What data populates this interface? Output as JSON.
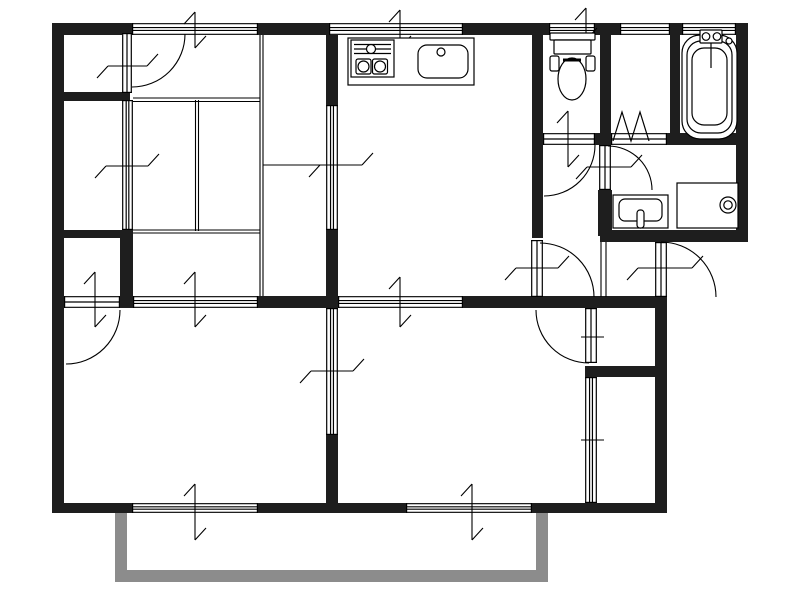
{
  "floorplan": {
    "canvas": {
      "width": 800,
      "height": 600,
      "background": "#ffffff"
    },
    "colors": {
      "wall": "#1e1e1e",
      "line": "#000000",
      "balcony": "#8c8c8c",
      "fill": "#ffffff"
    },
    "walls": [
      {
        "name": "outer-wall-top-1",
        "x": 52,
        "y": 23,
        "w": 80,
        "h": 12
      },
      {
        "name": "outer-wall-top-2",
        "x": 258,
        "y": 23,
        "w": 71,
        "h": 12
      },
      {
        "name": "outer-wall-top-3",
        "x": 463,
        "y": 23,
        "w": 86,
        "h": 12
      },
      {
        "name": "outer-wall-top-4",
        "x": 595,
        "y": 23,
        "w": 25,
        "h": 12
      },
      {
        "name": "outer-wall-top-5",
        "x": 670,
        "y": 23,
        "w": 12,
        "h": 12
      },
      {
        "name": "outer-wall-top-corner",
        "x": 736,
        "y": 23,
        "w": 12,
        "h": 12
      },
      {
        "name": "outer-wall-left",
        "x": 52,
        "y": 23,
        "w": 12,
        "h": 490
      },
      {
        "name": "outer-wall-bottom-1",
        "x": 52,
        "y": 503,
        "w": 80,
        "h": 10
      },
      {
        "name": "outer-wall-bottom-2",
        "x": 258,
        "y": 503,
        "w": 148,
        "h": 10
      },
      {
        "name": "outer-wall-bottom-3",
        "x": 532,
        "y": 503,
        "w": 135,
        "h": 10
      },
      {
        "name": "outer-wall-right-upper",
        "x": 736,
        "y": 23,
        "w": 12,
        "h": 219
      },
      {
        "name": "wall-washroom-south",
        "x": 600,
        "y": 230,
        "w": 148,
        "h": 12
      },
      {
        "name": "outer-wall-right-lower",
        "x": 655,
        "y": 297,
        "w": 12,
        "h": 216
      },
      {
        "name": "wall-kitchen-toilet",
        "x": 532,
        "y": 24,
        "w": 11,
        "h": 214
      },
      {
        "name": "wall-toilet-storage",
        "x": 600,
        "y": 24,
        "w": 11,
        "h": 109
      },
      {
        "name": "wall-storage-bath",
        "x": 670,
        "y": 35,
        "w": 10,
        "h": 110
      },
      {
        "name": "wall-toilet-south-chunk",
        "x": 595,
        "y": 133,
        "w": 16,
        "h": 12
      },
      {
        "name": "wall-bath-south",
        "x": 667,
        "y": 133,
        "w": 81,
        "h": 12
      },
      {
        "name": "wall-washroom-west",
        "x": 598,
        "y": 190,
        "w": 14,
        "h": 46
      },
      {
        "name": "wall-closet-nw-south",
        "x": 52,
        "y": 92,
        "w": 78,
        "h": 9
      },
      {
        "name": "wall-closet-w-south",
        "x": 52,
        "y": 230,
        "w": 81,
        "h": 8
      },
      {
        "name": "wall-closet-w-east",
        "x": 120,
        "y": 230,
        "w": 13,
        "h": 78
      },
      {
        "name": "wall-dk-west-upper",
        "x": 326,
        "y": 35,
        "w": 12,
        "h": 70
      },
      {
        "name": "wall-dk-west-lower",
        "x": 326,
        "y": 230,
        "w": 12,
        "h": 66
      },
      {
        "name": "wall-band-center",
        "x": 258,
        "y": 296,
        "w": 80,
        "h": 12
      },
      {
        "name": "wall-band-east",
        "x": 463,
        "y": 296,
        "w": 204,
        "h": 12
      },
      {
        "name": "wall-rooms-partition-lower",
        "x": 326,
        "y": 435,
        "w": 12,
        "h": 68
      },
      {
        "name": "wall-closet-se-divider",
        "x": 585,
        "y": 366,
        "w": 70,
        "h": 11
      }
    ],
    "balcony_rails": [
      {
        "name": "balcony-rail-left",
        "x": 115,
        "y": 513,
        "w": 12,
        "h": 69
      },
      {
        "name": "balcony-rail-bottom",
        "x": 115,
        "y": 570,
        "w": 433,
        "h": 12
      },
      {
        "name": "balcony-rail-right",
        "x": 536,
        "y": 513,
        "w": 12,
        "h": 69
      }
    ],
    "windows": [
      {
        "name": "window-top-tatami",
        "x": 132,
        "y": 23,
        "w": 126,
        "h": 12,
        "o": "h"
      },
      {
        "name": "window-top-kitchen",
        "x": 329,
        "y": 23,
        "w": 134,
        "h": 12,
        "o": "h"
      },
      {
        "name": "window-top-toilet",
        "x": 549,
        "y": 23,
        "w": 46,
        "h": 12,
        "o": "h"
      },
      {
        "name": "window-top-storage",
        "x": 620,
        "y": 23,
        "w": 50,
        "h": 12,
        "o": "h"
      },
      {
        "name": "window-top-bath",
        "x": 682,
        "y": 23,
        "w": 54,
        "h": 12,
        "o": "h"
      },
      {
        "name": "window-bottom-left",
        "x": 132,
        "y": 503,
        "w": 126,
        "h": 10,
        "o": "h"
      },
      {
        "name": "window-bottom-right",
        "x": 406,
        "y": 503,
        "w": 126,
        "h": 10,
        "o": "h"
      }
    ],
    "sliding_panels": [
      {
        "name": "fusuma-tatami-south",
        "x": 133,
        "y": 296,
        "w": 125,
        "h": 12,
        "o": "h"
      },
      {
        "name": "sliding-partition-dk-south",
        "x": 338,
        "y": 296,
        "w": 125,
        "h": 12,
        "o": "h"
      },
      {
        "name": "fusuma-closet-west",
        "x": 122,
        "y": 100,
        "w": 11,
        "h": 130,
        "o": "v"
      },
      {
        "name": "sliding-door-dk-west",
        "x": 326,
        "y": 105,
        "w": 12,
        "h": 125,
        "o": "v"
      },
      {
        "name": "sliding-partition-rooms",
        "x": 326,
        "y": 308,
        "w": 12,
        "h": 127,
        "o": "v"
      },
      {
        "name": "closet-front-southeast",
        "x": 585,
        "y": 377,
        "w": 12,
        "h": 126,
        "o": "v"
      }
    ],
    "door_leaves": [
      {
        "name": "closet-door-leaf-northwest",
        "x": 122,
        "y": 33,
        "w": 10,
        "h": 60,
        "o": "v"
      },
      {
        "name": "toilet-door-leaf",
        "x": 543,
        "y": 133,
        "w": 52,
        "h": 12,
        "o": "h"
      },
      {
        "name": "washroom-door-leaf",
        "x": 599,
        "y": 145,
        "w": 12,
        "h": 45,
        "o": "v"
      },
      {
        "name": "kitchen-door-leaf",
        "x": 531,
        "y": 240,
        "w": 12,
        "h": 57,
        "o": "v"
      },
      {
        "name": "entrance-door-leaf",
        "x": 655,
        "y": 242,
        "w": 12,
        "h": 55,
        "o": "v"
      },
      {
        "name": "closet-door-leaf-east",
        "x": 585,
        "y": 308,
        "w": 12,
        "h": 55,
        "o": "v"
      },
      {
        "name": "closet-door-leaf-west",
        "x": 64,
        "y": 296,
        "w": 56,
        "h": 12,
        "o": "h"
      }
    ],
    "door_arcs": [
      {
        "name": "closet-door-arc-northwest",
        "d": "M 185 34 A 53 53 0 0 1 132 87"
      },
      {
        "name": "toilet-door-arc",
        "d": "M 595 145 A 51 51 0 0 1 544 196"
      },
      {
        "name": "washroom-door-arc",
        "d": "M 608 146 A 44 44 0 0 1 652 190"
      },
      {
        "name": "kitchen-door-arc",
        "d": "M 540 243 A 54 54 0 0 1 594 297"
      },
      {
        "name": "entrance-door-arc",
        "d": "M 661 242 A 55 55 0 0 1 716 297"
      },
      {
        "name": "closet-door-arc-east",
        "d": "M 536 310 A 53 53 0 0 0 589 363"
      },
      {
        "name": "closet-door-arc-west",
        "d": "M 120 310 A 54 54 0 0 1 66 364"
      }
    ],
    "bifold_door": {
      "name": "bifold-door-storage",
      "band": {
        "x": 611,
        "y": 133,
        "w": 56,
        "h": 12,
        "o": "h"
      },
      "zigzag": "613,141 622,112 631,141 640,112 649,141"
    },
    "ticks": [
      {
        "name": "opening-mark",
        "t": "v",
        "x": 195,
        "a": 12,
        "b": 48,
        "hooks": true
      },
      {
        "name": "opening-mark",
        "t": "v",
        "x": 400,
        "a": 10,
        "b": 48,
        "hooks": true
      },
      {
        "name": "opening-mark",
        "t": "v",
        "x": 586,
        "a": 8,
        "b": 40,
        "hooks": true
      },
      {
        "name": "opening-mark",
        "t": "v",
        "x": 195,
        "a": 484,
        "b": 540,
        "hooks": true
      },
      {
        "name": "opening-mark",
        "t": "v",
        "x": 472,
        "a": 484,
        "b": 540,
        "hooks": true
      },
      {
        "name": "opening-mark",
        "t": "v",
        "x": 95,
        "a": 272,
        "b": 327,
        "hooks": true
      },
      {
        "name": "opening-mark",
        "t": "v",
        "x": 195,
        "a": 272,
        "b": 327,
        "hooks": true
      },
      {
        "name": "opening-mark",
        "t": "v",
        "x": 400,
        "a": 277,
        "b": 327,
        "hooks": true
      },
      {
        "name": "opening-mark",
        "t": "v",
        "x": 568,
        "a": 111,
        "b": 167,
        "hooks": true
      },
      {
        "name": "opening-mark",
        "t": "h",
        "y": 66,
        "a": 108,
        "b": 147,
        "hooks": true
      },
      {
        "name": "opening-mark",
        "t": "h",
        "y": 166,
        "a": 106,
        "b": 148,
        "hooks": true
      },
      {
        "name": "opening-mark",
        "t": "h",
        "y": 165,
        "a": 320,
        "b": 362,
        "hooks": true
      },
      {
        "name": "opening-mark",
        "t": "h",
        "y": 371,
        "a": 311,
        "b": 353,
        "hooks": true
      },
      {
        "name": "opening-mark",
        "t": "h",
        "y": 268,
        "a": 516,
        "b": 558,
        "hooks": true
      },
      {
        "name": "opening-mark",
        "t": "h",
        "y": 167,
        "a": 587,
        "b": 631,
        "hooks": true
      },
      {
        "name": "opening-mark",
        "t": "h",
        "y": 268,
        "a": 638,
        "b": 692,
        "hooks": true
      },
      {
        "name": "opening-mark",
        "t": "h",
        "y": 337,
        "a": 581,
        "b": 604,
        "hooks": false
      },
      {
        "name": "opening-mark",
        "t": "h",
        "y": 440,
        "a": 581,
        "b": 604,
        "hooks": false
      }
    ],
    "thin_lines": [
      {
        "name": "tatami-line",
        "x1": 133,
        "y1": 98,
        "x2": 260,
        "y2": 98
      },
      {
        "name": "tatami-line",
        "x1": 133,
        "y1": 101.5,
        "x2": 260,
        "y2": 101.5
      },
      {
        "name": "tatami-line",
        "x1": 195.5,
        "y1": 100,
        "x2": 195.5,
        "y2": 231
      },
      {
        "name": "tatami-line",
        "x1": 198.5,
        "y1": 100,
        "x2": 198.5,
        "y2": 231
      },
      {
        "name": "tatami-line",
        "x1": 133,
        "y1": 230,
        "x2": 260,
        "y2": 230
      },
      {
        "name": "tatami-line",
        "x1": 133,
        "y1": 233,
        "x2": 260,
        "y2": 233
      },
      {
        "name": "closet-front-line",
        "x1": 260,
        "y1": 35,
        "x2": 260,
        "y2": 296
      },
      {
        "name": "closet-front-line",
        "x1": 263,
        "y1": 35,
        "x2": 263,
        "y2": 296
      },
      {
        "name": "closet-divider-line",
        "x1": 263,
        "y1": 165,
        "x2": 326,
        "y2": 165
      },
      {
        "name": "genkan-step-line",
        "x1": 601,
        "y1": 242,
        "x2": 601,
        "y2": 297
      },
      {
        "name": "genkan-step-line",
        "x1": 606,
        "y1": 242,
        "x2": 606,
        "y2": 297
      }
    ],
    "fixtures": [
      {
        "name": "kitchen-counter",
        "shapes": [
          {
            "k": "rect",
            "x": 348,
            "y": 38,
            "w": 126,
            "h": 47,
            "rx": 0
          }
        ]
      },
      {
        "name": "gas-stove",
        "shapes": [
          {
            "k": "rect",
            "x": 351,
            "y": 40,
            "w": 43,
            "h": 37,
            "rx": 0
          },
          {
            "k": "line",
            "x1": 354,
            "y1": 44.5,
            "x2": 391,
            "y2": 44.5
          },
          {
            "k": "line",
            "x1": 354,
            "y1": 49,
            "x2": 391,
            "y2": 49
          },
          {
            "k": "line",
            "x1": 354,
            "y1": 53.5,
            "x2": 391,
            "y2": 53.5
          },
          {
            "k": "circle",
            "cx": 371,
            "cy": 49,
            "r": 4.5
          },
          {
            "k": "rect",
            "x": 356,
            "y": 59,
            "w": 15,
            "h": 15,
            "rx": 2
          },
          {
            "k": "rect",
            "x": 372.5,
            "y": 59,
            "w": 15,
            "h": 15,
            "rx": 2
          },
          {
            "k": "circle",
            "cx": 363.5,
            "cy": 66.5,
            "r": 5.5
          },
          {
            "k": "circle",
            "cx": 380,
            "cy": 66.5,
            "r": 5.5
          }
        ]
      },
      {
        "name": "kitchen-sink",
        "shapes": [
          {
            "k": "rect",
            "x": 418,
            "y": 45,
            "w": 50,
            "h": 33,
            "rx": 9
          },
          {
            "k": "circle",
            "cx": 441,
            "cy": 52,
            "r": 4
          }
        ]
      },
      {
        "name": "toilet",
        "shapes": [
          {
            "k": "rect",
            "x": 550,
            "y": 33,
            "w": 45,
            "h": 7,
            "rx": 1
          },
          {
            "k": "rect",
            "x": 554,
            "y": 40,
            "w": 37,
            "h": 14,
            "rx": 1
          },
          {
            "k": "rect",
            "x": 550,
            "y": 56,
            "w": 9,
            "h": 15,
            "rx": 2
          },
          {
            "k": "rect",
            "x": 586,
            "y": 56,
            "w": 9,
            "h": 15,
            "rx": 2
          },
          {
            "k": "ellipse",
            "cx": 572,
            "cy": 79,
            "rx": 14,
            "ry": 21
          },
          {
            "k": "line",
            "x1": 563,
            "y1": 60,
            "x2": 581,
            "y2": 60,
            "sw": 3
          }
        ]
      },
      {
        "name": "bathtub",
        "shapes": [
          {
            "k": "rect",
            "x": 682,
            "y": 35,
            "w": 55,
            "h": 104,
            "rx": 18
          },
          {
            "k": "rect",
            "x": 687,
            "y": 41,
            "w": 45,
            "h": 92,
            "rx": 14
          },
          {
            "k": "rect",
            "x": 692,
            "y": 48,
            "w": 35,
            "h": 77,
            "rx": 12
          },
          {
            "k": "rect",
            "x": 700,
            "y": 30,
            "w": 22,
            "h": 13,
            "rx": 1
          },
          {
            "k": "circle",
            "cx": 706,
            "cy": 36.5,
            "r": 3.8
          },
          {
            "k": "circle",
            "cx": 717,
            "cy": 36.5,
            "r": 3.8
          },
          {
            "k": "line",
            "x1": 711,
            "y1": 43,
            "x2": 711,
            "y2": 68
          },
          {
            "k": "circle",
            "cx": 729,
            "cy": 41,
            "r": 3
          }
        ]
      },
      {
        "name": "washbasin",
        "shapes": [
          {
            "k": "rect",
            "x": 613,
            "y": 195,
            "w": 55,
            "h": 33,
            "rx": 0
          },
          {
            "k": "rect",
            "x": 619,
            "y": 199,
            "w": 43,
            "h": 22,
            "rx": 6
          },
          {
            "k": "rect",
            "x": 637,
            "y": 210,
            "w": 7,
            "h": 18,
            "rx": 3
          }
        ]
      },
      {
        "name": "washing-machine-pan",
        "shapes": [
          {
            "k": "rect",
            "x": 677,
            "y": 183,
            "w": 61,
            "h": 45,
            "rx": 0
          },
          {
            "k": "circle",
            "cx": 728,
            "cy": 205,
            "r": 8
          },
          {
            "k": "circle",
            "cx": 728,
            "cy": 205,
            "r": 4.2
          }
        ]
      }
    ]
  }
}
